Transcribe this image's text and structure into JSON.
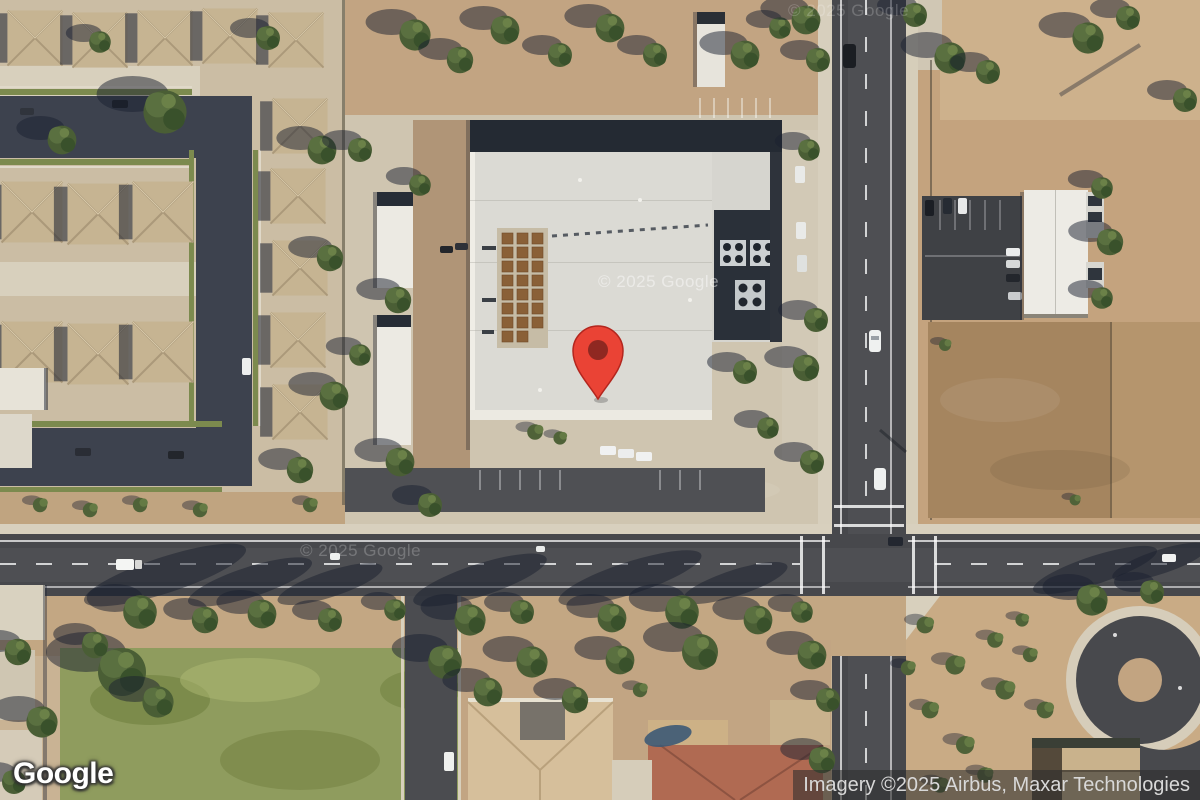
{
  "canvas": {
    "width": 1200,
    "height": 800,
    "view_type": "satellite"
  },
  "marker": {
    "name": "red-location-pin",
    "fill": "#EA4335",
    "stroke": "#B3261E",
    "dot": "#7F231D",
    "anchor_x": 598,
    "anchor_y": 399
  },
  "watermarks": [
    {
      "text": "© 2025 Google"
    },
    {
      "text": "© 2025 Google"
    },
    {
      "text": "© 2025 Google"
    }
  ],
  "footer": {
    "logo_text": "Google",
    "attribution_text": "Imagery ©2025 Airbus, Maxar Technologies"
  },
  "palette": {
    "asphalt": "#47484C",
    "residential_street": "#3D424E",
    "dirt": "#C4A37E",
    "brown_lot": "#A5855F",
    "concrete": "#CFC5B0",
    "grass": "#8F9C5E",
    "building_roof": "#DBDAD4",
    "house_roof": "#C6B492",
    "tree": "#4A5E35"
  }
}
